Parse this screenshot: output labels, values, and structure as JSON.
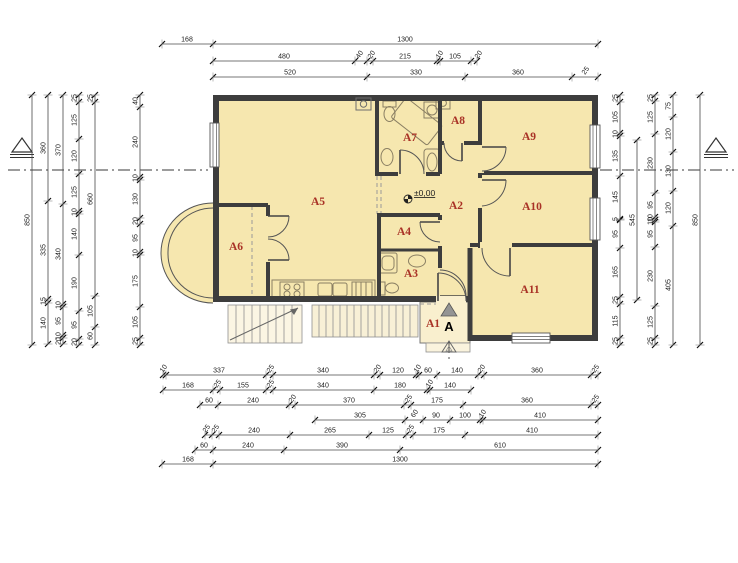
{
  "colors": {
    "room_fill": "#f6e7af",
    "porch_fill": "#f9efce",
    "steps_fill": "#faf3dd",
    "wall": "#3d3d3d",
    "label_red": "#a93226",
    "marker_gray": "#949494"
  },
  "annotations": {
    "level": "±0,00",
    "section": "A"
  },
  "rooms": [
    "A1",
    "A2",
    "A3",
    "A4",
    "A5",
    "A6",
    "A7",
    "A8",
    "A9",
    "A10",
    "A11"
  ],
  "dimensions": {
    "top": [
      [
        "168",
        "1300"
      ],
      [
        "480",
        "40",
        "20",
        "215",
        "10",
        "105",
        "20"
      ],
      [
        "520",
        "330",
        "360",
        "25"
      ]
    ],
    "bottom": [
      [
        "10",
        "337",
        "25",
        "340",
        "20",
        "120",
        "10",
        "60",
        "140",
        "20",
        "360",
        "25"
      ],
      [
        "168",
        "25",
        "155",
        "25",
        "340",
        "180",
        "10",
        "140"
      ],
      [
        "60",
        "240",
        "20",
        "370",
        "25",
        "175",
        "360",
        "25"
      ],
      [
        "305",
        "60",
        "90",
        "100",
        "10",
        "410"
      ],
      [
        "25",
        "25",
        "240",
        "265",
        "125",
        "25",
        "175",
        "410"
      ],
      [
        "60",
        "240",
        "390",
        "610"
      ],
      [
        "168",
        "1300"
      ]
    ],
    "left": [
      [
        "850"
      ],
      [
        "360",
        "335",
        "15",
        "140"
      ],
      [
        "370",
        "340",
        "10",
        "95",
        "10",
        "20"
      ],
      [
        "25",
        "125",
        "120",
        "125",
        "10",
        "140",
        "190",
        "95",
        "20"
      ],
      [
        "25",
        "660",
        "105",
        "60"
      ],
      [
        "40",
        "240",
        "10",
        "130",
        "20",
        "95",
        "10",
        "175",
        "105",
        "25"
      ]
    ],
    "right": [
      [
        "25",
        "105",
        "10",
        "135",
        "145",
        "5",
        "95",
        "165",
        "25",
        "115",
        "25"
      ],
      [
        "545"
      ],
      [
        "25",
        "125",
        "230",
        "95",
        "10",
        "10",
        "95",
        "230",
        "125",
        "25"
      ],
      [
        "75",
        "120",
        "130",
        "120",
        "405"
      ],
      [
        "850"
      ]
    ]
  }
}
